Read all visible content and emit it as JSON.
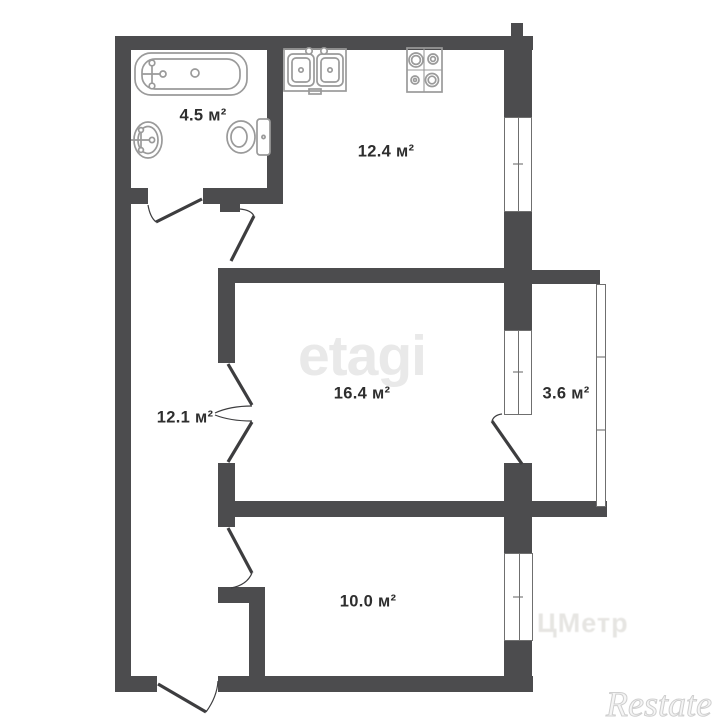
{
  "plan": {
    "rooms": {
      "bathroom": {
        "area": "4.5 м²"
      },
      "kitchen": {
        "area": "12.4 м²"
      },
      "living_room": {
        "area": "16.4 м²"
      },
      "hallway": {
        "area": "12.1 м²"
      },
      "balcony": {
        "area": "3.6 м²"
      },
      "bedroom": {
        "area": "10.0 м²"
      }
    },
    "fixture_icons": [
      "bathtub-icon",
      "sink-icon",
      "toilet-icon",
      "double-sink-icon",
      "stove-icon"
    ]
  },
  "watermarks": {
    "etagi": "etagi",
    "restate": "Restate",
    "faint": "ЦМетр"
  },
  "colors": {
    "wall": "#4c4c4e",
    "door": "#3d3d3f",
    "fixture": "#9a9a9a",
    "window_frame": "#6f6f6f",
    "label": "#2e2e2e",
    "watermark_etagi": "#e9e9e9",
    "watermark_restate": "#cfcfcf",
    "watermark_faint": "rgba(167,163,152,0.28)"
  }
}
